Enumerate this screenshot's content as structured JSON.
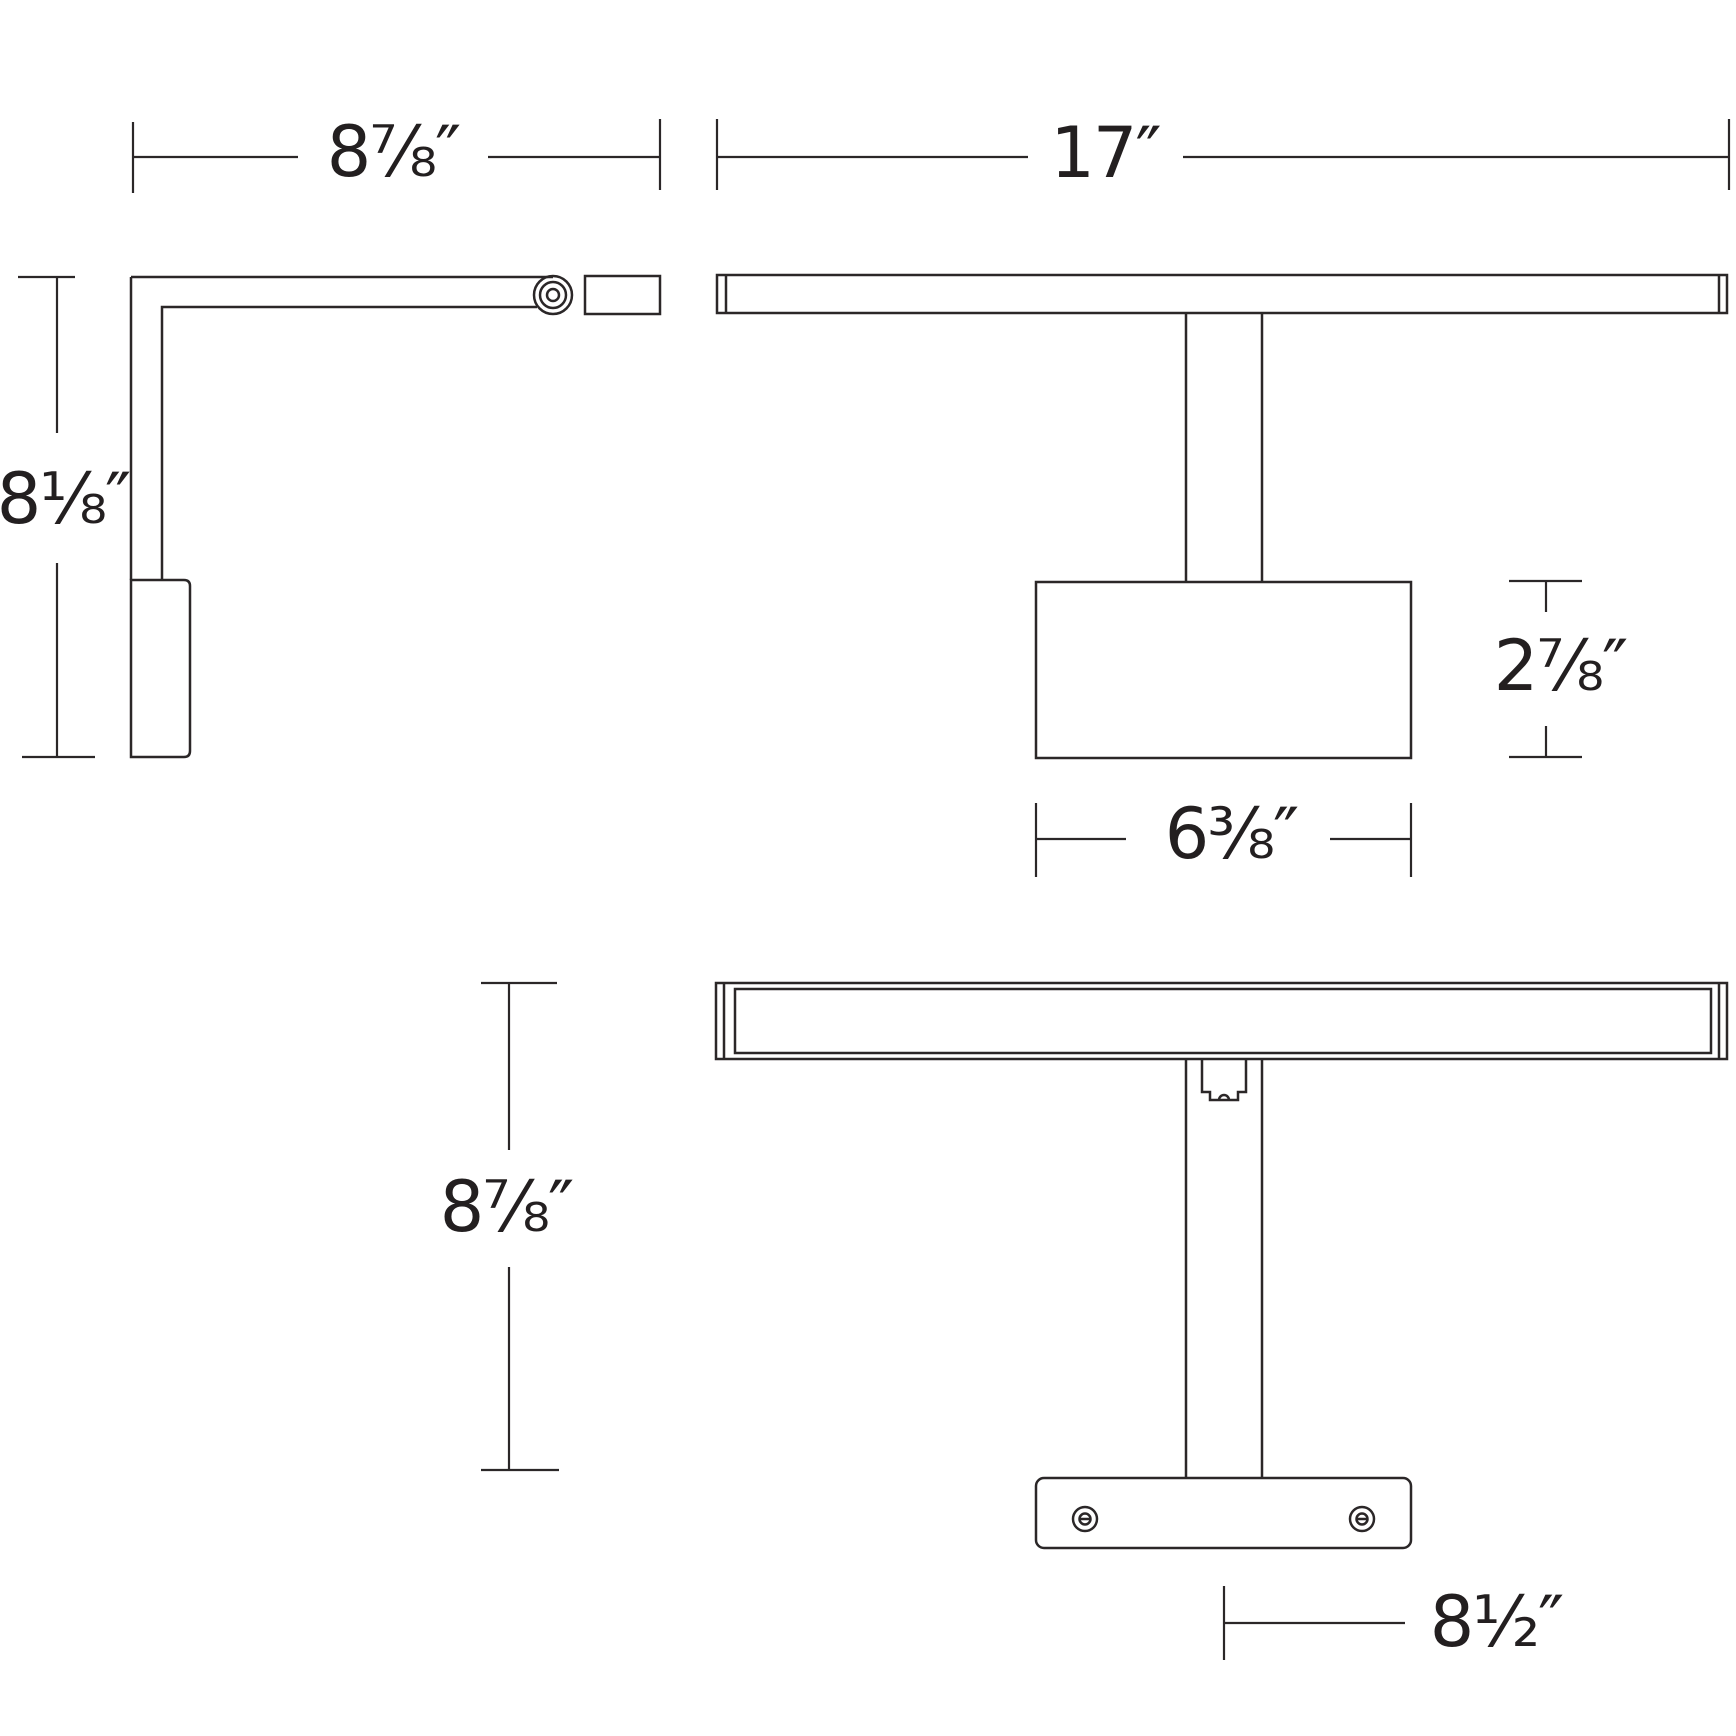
{
  "drawing": {
    "background_color": "#ffffff",
    "line_color": "#2b2728",
    "text_color": "#231f20",
    "dimensions": {
      "side_width": "8⅞″",
      "side_height": "8⅛″",
      "front_width": "17″",
      "backplate_height": "2⅞″",
      "backplate_width": "6⅜″",
      "top_depth": "8⅞″",
      "backplate_length": "8½″"
    }
  }
}
